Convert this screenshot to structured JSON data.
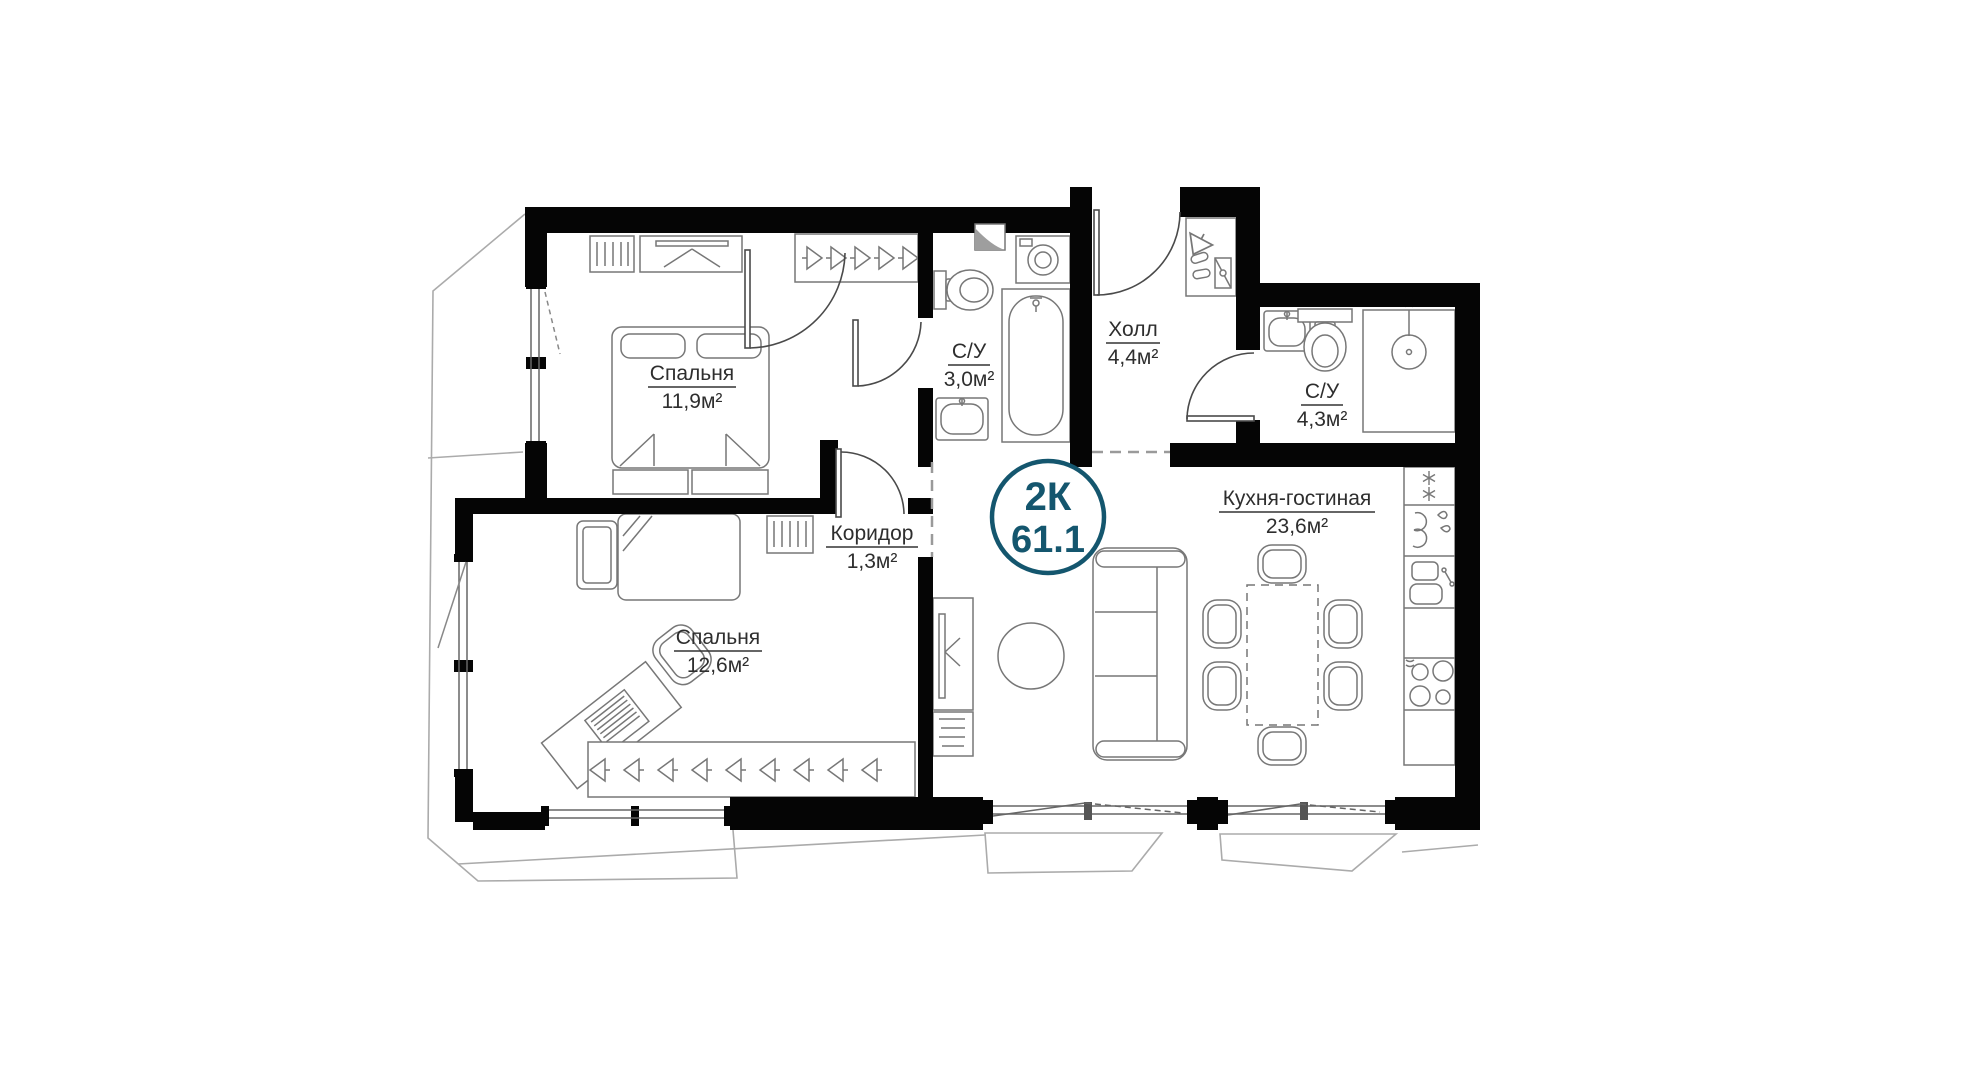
{
  "plan": {
    "badge": {
      "type": "2К",
      "area": "61.1"
    },
    "rooms": {
      "bedroom1": {
        "name": "Спальня",
        "area": "11,9м²"
      },
      "bathroom1": {
        "name": "С/У",
        "area": "3,0м²"
      },
      "hall": {
        "name": "Холл",
        "area": "4,4м²"
      },
      "bathroom2": {
        "name": "С/У",
        "area": "4,3м²"
      },
      "corridor": {
        "name": "Коридор",
        "area": "1,3м²"
      },
      "bedroom2": {
        "name": "Спальня",
        "area": "12,6м²"
      },
      "kitchen_living": {
        "name": "Кухня-гостиная",
        "area": "23,6м²"
      }
    },
    "colors": {
      "badge": "#14566E",
      "walls": "#050505",
      "furniture_line": "#777777",
      "background": "#FFFFFF"
    }
  }
}
